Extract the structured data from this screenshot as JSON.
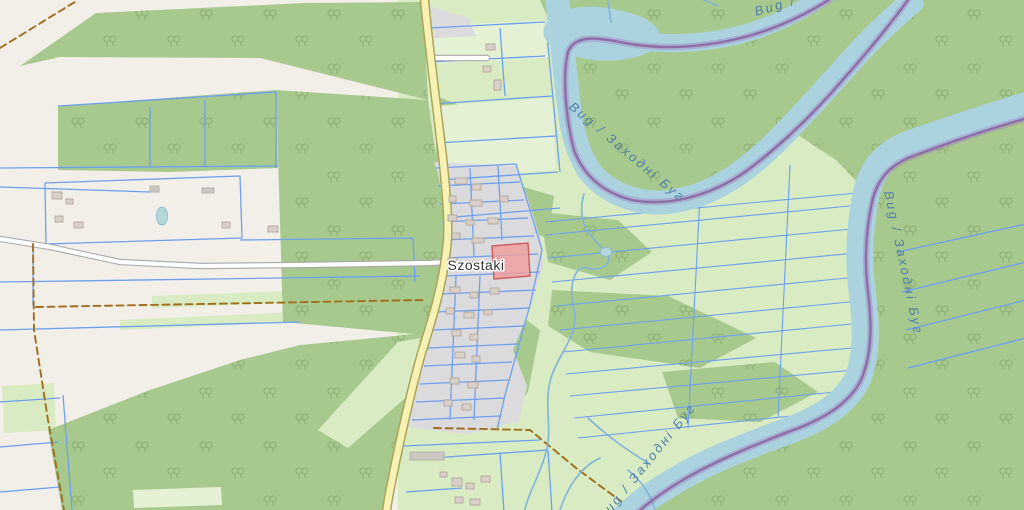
{
  "map": {
    "place": "Szostaki",
    "river_name_full": "Bug / Заходні Буг",
    "river_name_short": "Bug /"
  },
  "colors": {
    "land": "#f2efe9",
    "meadow": "#d9ebc2",
    "meadow_light": "#e4f1d4",
    "forest": "#a8c98e",
    "tree_symbol": "#8dae72",
    "water": "#abd3df",
    "water_line": "#7fb4d8",
    "water_label": "#4d7ea8",
    "boundary": "#8a62a0",
    "boundary_halo": "#9d6bb5",
    "parcel_line": "#6ca0f1",
    "road_yellow": "#f7f2b4",
    "road_yellow_casing": "#a8a25b",
    "road_white": "#ffffff",
    "road_white_casing": "#a8a8a8",
    "residential": "#dbdadc",
    "building": "#d9d0c9",
    "building_outline": "#b4a69a",
    "selected_parcel": "#efa0a0",
    "selected_parcel_border": "#cc5c5c",
    "track": "#a06e1f",
    "pond": "#b5d6d6",
    "place_label": "#333333"
  }
}
